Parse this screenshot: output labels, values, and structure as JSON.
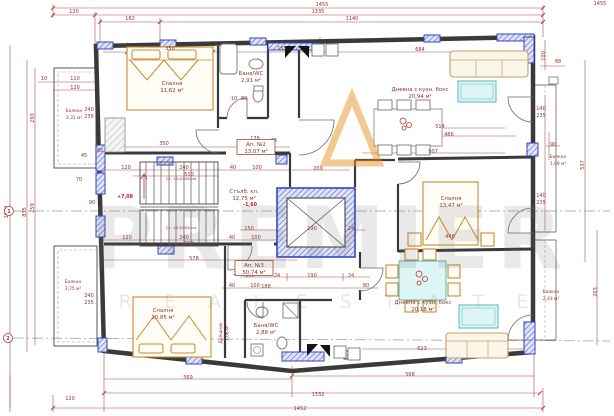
{
  "plan": {
    "watermark": {
      "line1": "PREMIER",
      "line2": "R E A L  E S T A T E"
    },
    "colors": {
      "dimension_lines": "#a23b38",
      "label_text": "#8e3432",
      "walls": "#3a3a3a",
      "columns_blue": "#3344bb",
      "column_hatch_fill": "#dfe3f8",
      "furniture_orange": "#c98a2f",
      "table_cyan": "#def5f5",
      "level_red": "#c22020",
      "watermark_gray": "rgba(110,110,110,0.15)",
      "logo_orange": "#e8941f"
    },
    "axes": [
      {
        "label": "1",
        "x": 9,
        "y": 211
      },
      {
        "label": "2",
        "x": 8,
        "y": 338
      }
    ],
    "labels": [
      {
        "name": "Спалня",
        "area": "11,62 м²",
        "x": 172,
        "y": 85
      },
      {
        "name": "Баня/WC",
        "area": "2,91 м²",
        "x": 251,
        "y": 75
      },
      {
        "name": "Дневна с кухн. бокс",
        "area": "20,94 м²",
        "x": 420,
        "y": 91
      },
      {
        "name": "Спалня",
        "area": "13,47 м²",
        "x": 451,
        "y": 200
      },
      {
        "name": "Стълб. кл.",
        "area": "12,75 м²",
        "x": 244,
        "y": 193
      },
      {
        "name": "Спалня",
        "area": "10,85 м²",
        "x": 163,
        "y": 312
      },
      {
        "name": "Баня/WC",
        "area": "2,88 м²",
        "x": 266,
        "y": 327
      },
      {
        "name": "Дневна с кухн. бокс",
        "area": "20,18 м²",
        "x": 423,
        "y": 304
      },
      {
        "name": "Балкон",
        "area": "3,31 м²",
        "x": 74,
        "y": 112,
        "small": true
      },
      {
        "name": "Балкон",
        "area": "3,75 м²",
        "x": 73,
        "y": 283,
        "small": true
      },
      {
        "name": "Балкон",
        "area": "1,09 м²",
        "x": 558,
        "y": 158,
        "small": true
      },
      {
        "name": "Балкон",
        "area": "2,43 м²",
        "x": 551,
        "y": 293,
        "small": true
      },
      {
        "name": "Дрешник",
        "area": "1,06 м²",
        "x": 222,
        "y": 333,
        "r": -90,
        "small": true
      },
      {
        "name": "Ап. №2",
        "area": "13,07 м²",
        "x": 256,
        "y": 146,
        "boxed": true
      },
      {
        "name": "Ап. №3",
        "area": "50,74 м²",
        "x": 254,
        "y": 267,
        "boxed": true
      }
    ],
    "levels": [
      {
        "t": "+7,08",
        "x": 125,
        "y": 198
      },
      {
        "t": "-1,60",
        "x": 250,
        "y": 206
      }
    ],
    "notes": [
      {
        "t": "Ст. 18.4/280 см",
        "x": 181,
        "y": 180
      },
      {
        "t": "Ст. 18.4/280 см",
        "x": 181,
        "y": 229
      }
    ],
    "dims": [
      {
        "t": "1455",
        "x": 322,
        "y": 6
      },
      {
        "t": "1455",
        "x": 600,
        "y": 5
      },
      {
        "t": "120",
        "x": 74,
        "y": 13
      },
      {
        "t": "1335",
        "x": 318,
        "y": 13
      },
      {
        "t": "182",
        "x": 130,
        "y": 20
      },
      {
        "t": "1140",
        "x": 352,
        "y": 20
      },
      {
        "t": "350",
        "x": 170,
        "y": 50
      },
      {
        "t": "155",
        "x": 282,
        "y": 50
      },
      {
        "t": "684",
        "x": 420,
        "y": 51
      },
      {
        "t": "1040",
        "x": 8,
        "y": 212,
        "r": -90
      },
      {
        "t": "835",
        "x": 26,
        "y": 212,
        "r": -90
      },
      {
        "t": "293",
        "x": 34,
        "y": 118,
        "r": -90
      },
      {
        "t": "259",
        "x": 34,
        "y": 208,
        "r": -90
      },
      {
        "t": "10",
        "x": 44,
        "y": 80
      },
      {
        "t": "110",
        "x": 75,
        "y": 80
      },
      {
        "t": "120",
        "x": 75,
        "y": 89
      },
      {
        "t": "45",
        "x": 84,
        "y": 157
      },
      {
        "t": "70",
        "x": 79,
        "y": 181
      },
      {
        "t": "90",
        "x": 92,
        "y": 204
      },
      {
        "t": "240",
        "x": 89,
        "y": 111
      },
      {
        "t": "235",
        "x": 89,
        "y": 118
      },
      {
        "t": "240",
        "x": 89,
        "y": 297
      },
      {
        "t": "235",
        "x": 89,
        "y": 304
      },
      {
        "t": "120",
        "x": 70,
        "y": 400
      },
      {
        "t": "100",
        "x": 545,
        "y": 56,
        "r": -90
      },
      {
        "t": "88",
        "x": 558,
        "y": 63
      },
      {
        "t": "537",
        "x": 584,
        "y": 165,
        "r": -90
      },
      {
        "t": "263",
        "x": 597,
        "y": 292,
        "r": -90
      },
      {
        "t": "140",
        "x": 541,
        "y": 110
      },
      {
        "t": "235",
        "x": 541,
        "y": 117
      },
      {
        "t": "90",
        "x": 553,
        "y": 146
      },
      {
        "t": "140",
        "x": 541,
        "y": 197
      },
      {
        "t": "235",
        "x": 541,
        "y": 204
      },
      {
        "t": "569",
        "x": 188,
        "y": 379
      },
      {
        "t": "568",
        "x": 410,
        "y": 376
      },
      {
        "t": "623",
        "x": 422,
        "y": 350
      },
      {
        "t": "1332",
        "x": 318,
        "y": 396
      },
      {
        "t": "1452",
        "x": 300,
        "y": 410
      },
      {
        "t": "120",
        "x": 126,
        "y": 169
      },
      {
        "t": "240",
        "x": 184,
        "y": 169
      },
      {
        "t": "40",
        "x": 233,
        "y": 169
      },
      {
        "t": "100",
        "x": 257,
        "y": 169
      },
      {
        "t": "510",
        "x": 189,
        "y": 176
      },
      {
        "t": "209",
        "x": 318,
        "y": 170
      },
      {
        "t": "120",
        "x": 127,
        "y": 239
      },
      {
        "t": "240",
        "x": 184,
        "y": 239
      },
      {
        "t": "40",
        "x": 232,
        "y": 239
      },
      {
        "t": "100",
        "x": 256,
        "y": 239
      },
      {
        "t": "510",
        "x": 189,
        "y": 245
      },
      {
        "t": "578",
        "x": 194,
        "y": 260
      },
      {
        "t": "150",
        "x": 249,
        "y": 230
      },
      {
        "t": "190",
        "x": 312,
        "y": 230
      },
      {
        "t": "24",
        "x": 351,
        "y": 230
      },
      {
        "t": "150",
        "x": 250,
        "y": 277
      },
      {
        "t": "24",
        "x": 277,
        "y": 277
      },
      {
        "t": "190",
        "x": 312,
        "y": 277
      },
      {
        "t": "24",
        "x": 351,
        "y": 277
      },
      {
        "t": "40",
        "x": 232,
        "y": 287
      },
      {
        "t": "100",
        "x": 255,
        "y": 287
      },
      {
        "t": "80",
        "x": 366,
        "y": 287
      },
      {
        "t": "178",
        "x": 255,
        "y": 140
      },
      {
        "t": "35",
        "x": 274,
        "y": 142
      },
      {
        "t": "350",
        "x": 164,
        "y": 145
      },
      {
        "t": "85",
        "x": 100,
        "y": 152
      },
      {
        "t": "514",
        "x": 440,
        "y": 128
      },
      {
        "t": "486",
        "x": 449,
        "y": 136
      },
      {
        "t": "507",
        "x": 433,
        "y": 153
      },
      {
        "t": "448",
        "x": 450,
        "y": 238
      },
      {
        "t": "188",
        "x": 266,
        "y": 288
      },
      {
        "t": "90",
        "x": 238,
        "y": 269
      },
      {
        "t": "200",
        "x": 238,
        "y": 275
      },
      {
        "t": "10",
        "x": 234,
        "y": 100
      },
      {
        "t": "80",
        "x": 244,
        "y": 100
      }
    ]
  }
}
